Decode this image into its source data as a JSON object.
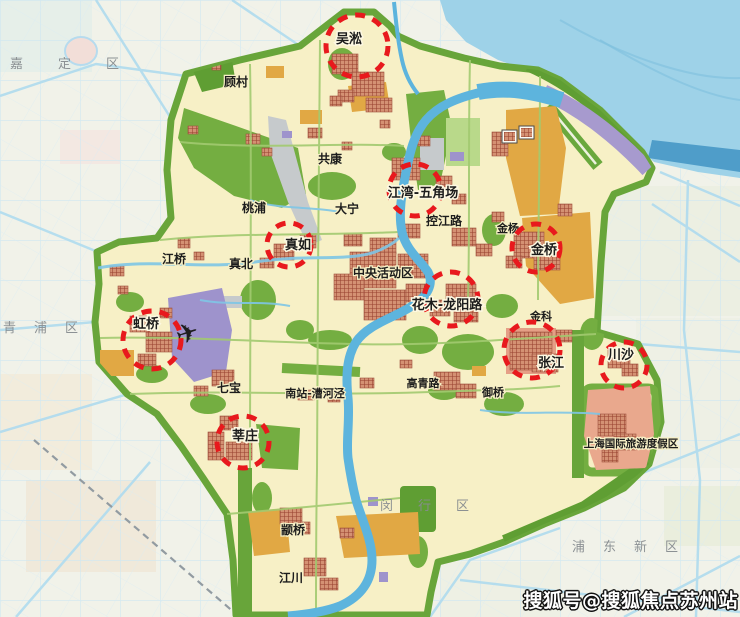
{
  "watermark": {
    "text": "搜狐号@搜狐焦点苏州站"
  },
  "colors": {
    "subcenter_ring": "#e8191d",
    "label_dark": "#1c1c1c",
    "district_label": "#878c90",
    "planning_fill": "#f7f0c6",
    "green": "#74ae41",
    "water": "#9ed2e8",
    "river": "#5db4dd",
    "urban_block": "#b2604a",
    "orange": "#e1a844",
    "purple": "#9e93cc",
    "watermark_fill": "#ffffff",
    "watermark_outline": "#111111"
  },
  "map": {
    "subcenters": [
      {
        "label": "吴淞",
        "cx": 357,
        "cy": 46,
        "r": 31,
        "lx": 349,
        "ly": 43
      },
      {
        "label": "江湾-五角场",
        "cx": 415,
        "cy": 190,
        "r": 26,
        "lx": 423,
        "ly": 197
      },
      {
        "label": "真如",
        "cx": 289,
        "cy": 245,
        "r": 22,
        "lx": 298,
        "ly": 249
      },
      {
        "label": "虹桥",
        "cx": 152,
        "cy": 340,
        "r": 29,
        "lx": 146,
        "ly": 328
      },
      {
        "label": "金桥",
        "cx": 536,
        "cy": 248,
        "r": 24,
        "lx": 544,
        "ly": 254
      },
      {
        "label": "花木-龙阳路",
        "cx": 451,
        "cy": 299,
        "r": 27,
        "lx": 447,
        "ly": 309
      },
      {
        "label": "张江",
        "cx": 532,
        "cy": 350,
        "r": 28,
        "lx": 551,
        "ly": 367
      },
      {
        "label": "川沙",
        "cx": 624,
        "cy": 365,
        "r": 23,
        "lx": 621,
        "ly": 359
      },
      {
        "label": "莘庄",
        "cx": 243,
        "cy": 442,
        "r": 26,
        "lx": 245,
        "ly": 440
      }
    ],
    "area_labels": [
      {
        "text": "顾村",
        "x": 236,
        "y": 86
      },
      {
        "text": "共康",
        "x": 330,
        "y": 163
      },
      {
        "text": "桃浦",
        "x": 254,
        "y": 212
      },
      {
        "text": "大宁",
        "x": 347,
        "y": 213
      },
      {
        "text": "控江路",
        "x": 444,
        "y": 225
      },
      {
        "text": "金杨",
        "x": 508,
        "y": 232,
        "size": 11
      },
      {
        "text": "江桥",
        "x": 174,
        "y": 263
      },
      {
        "text": "真北",
        "x": 241,
        "y": 268
      },
      {
        "text": "中央活动区",
        "x": 383,
        "y": 277
      },
      {
        "text": "金科",
        "x": 541,
        "y": 320,
        "size": 11
      },
      {
        "text": "七宝",
        "x": 229,
        "y": 392
      },
      {
        "text": "南站-漕河泾",
        "x": 315,
        "y": 397,
        "size": 11
      },
      {
        "text": "高青路",
        "x": 423,
        "y": 387,
        "size": 11
      },
      {
        "text": "御桥",
        "x": 493,
        "y": 396,
        "size": 11
      },
      {
        "text": "上海国际旅游度假区",
        "x": 631,
        "y": 447,
        "size": 10.5
      },
      {
        "text": "颛桥",
        "x": 293,
        "y": 534
      },
      {
        "text": "江川",
        "x": 291,
        "y": 582
      }
    ],
    "district_labels": [
      {
        "text": "嘉定区",
        "x": 10,
        "y": 68,
        "spacing": 35
      },
      {
        "text": "青浦区",
        "x": 3,
        "y": 332,
        "spacing": 18
      },
      {
        "text": "闵行区",
        "x": 380,
        "y": 510,
        "spacing": 25
      },
      {
        "text": "浦东新区",
        "x": 572,
        "y": 551,
        "spacing": 18
      }
    ],
    "icons": [
      {
        "name": "airplane-icon",
        "glyph": "✈",
        "x": 190,
        "y": 342,
        "size": 27,
        "rotate": -18
      },
      {
        "name": "building-icon",
        "x": 502,
        "y": 130
      },
      {
        "name": "building-icon",
        "x": 519,
        "y": 126
      }
    ]
  }
}
